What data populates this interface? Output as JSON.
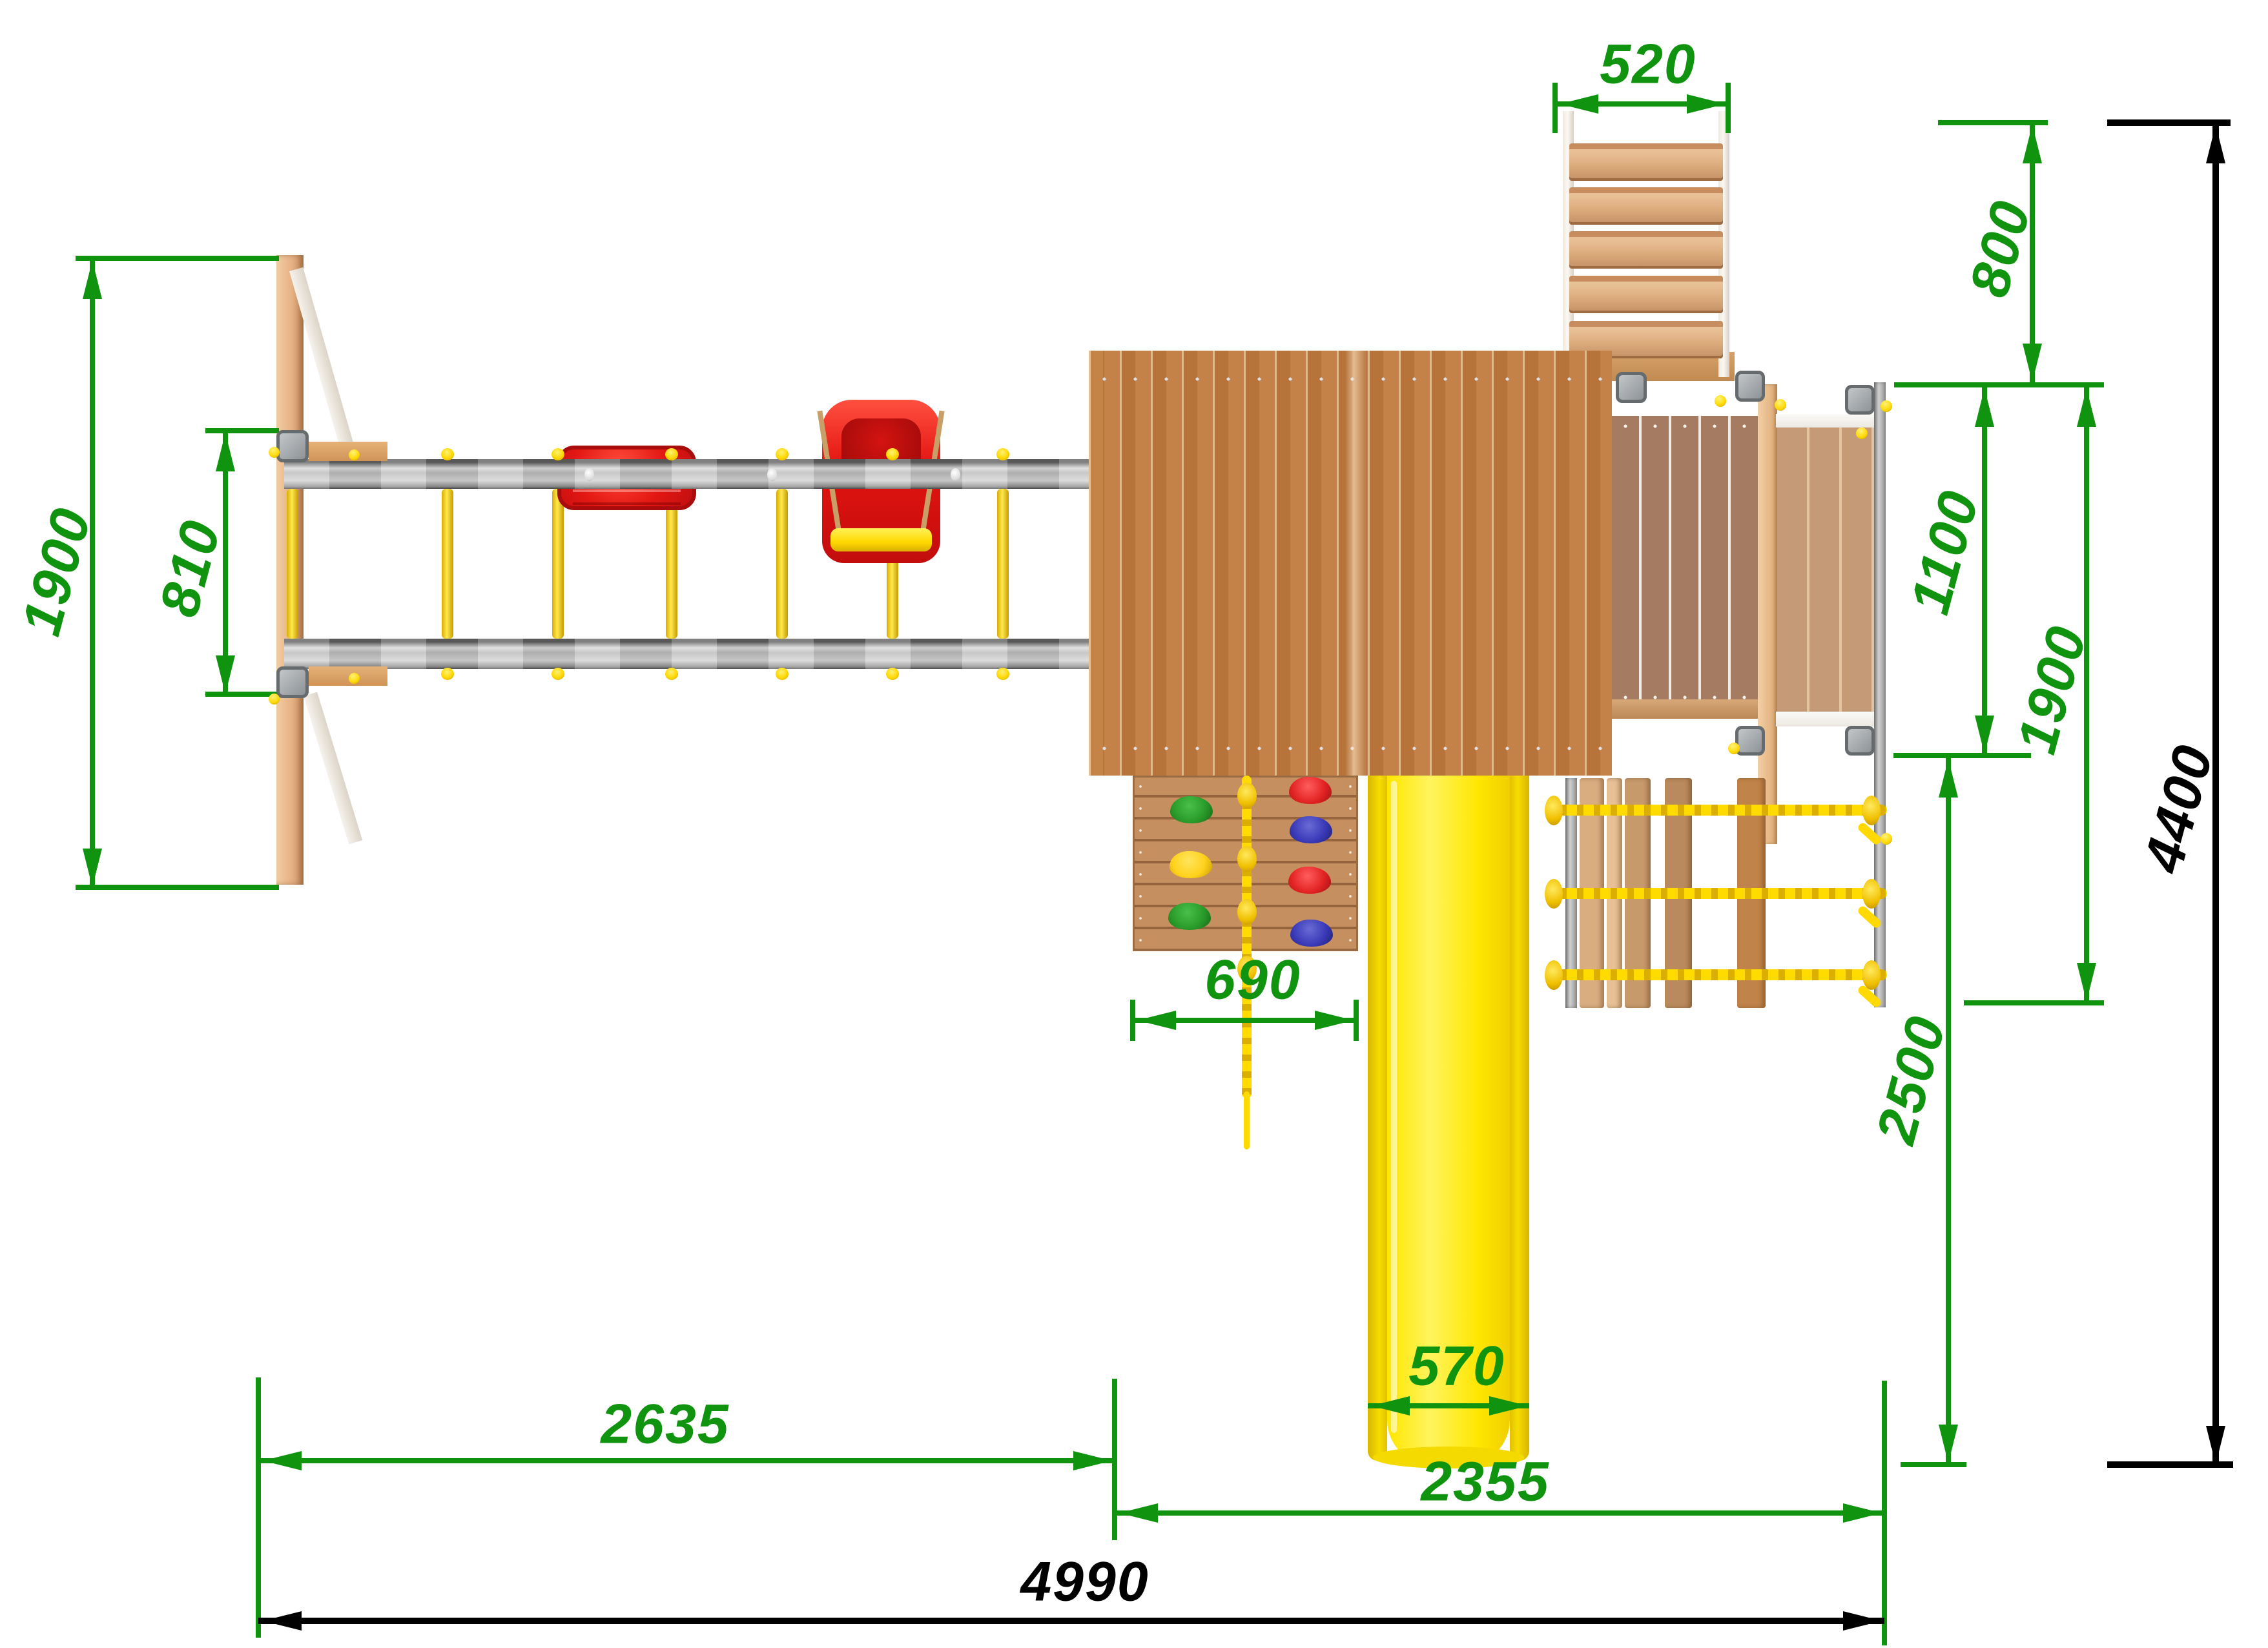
{
  "drawing": {
    "type": "playground-top-view-dimension-drawing",
    "view": "plan (top) view",
    "units": "mm"
  },
  "labels": {
    "d520": "520",
    "d800": "800",
    "d1900_left": "1900",
    "d810": "810",
    "d1100": "1100",
    "d1900_right": "1900",
    "d4400": "4400",
    "d690": "690",
    "d2500": "2500",
    "d570": "570",
    "d2635": "2635",
    "d2355": "2355",
    "d4990": "4990"
  },
  "colors": {
    "dimension_green": "#10930f",
    "dimension_black": "#000000",
    "beam_gray": "#bcbcbc",
    "rung_yellow": "#ffd800",
    "slide_yellow": "#ffe600",
    "seat_red": "#e31713",
    "roof_wood": "#c07a3e",
    "deck_wood": "#a57c61",
    "plywood_light": "#e9b98c",
    "rope_yellow": "#ffdb00",
    "hold_green": "#2ea12e",
    "hold_yellow": "#ffd21c",
    "hold_red": "#e83030",
    "hold_blue": "#3a3ab8"
  }
}
